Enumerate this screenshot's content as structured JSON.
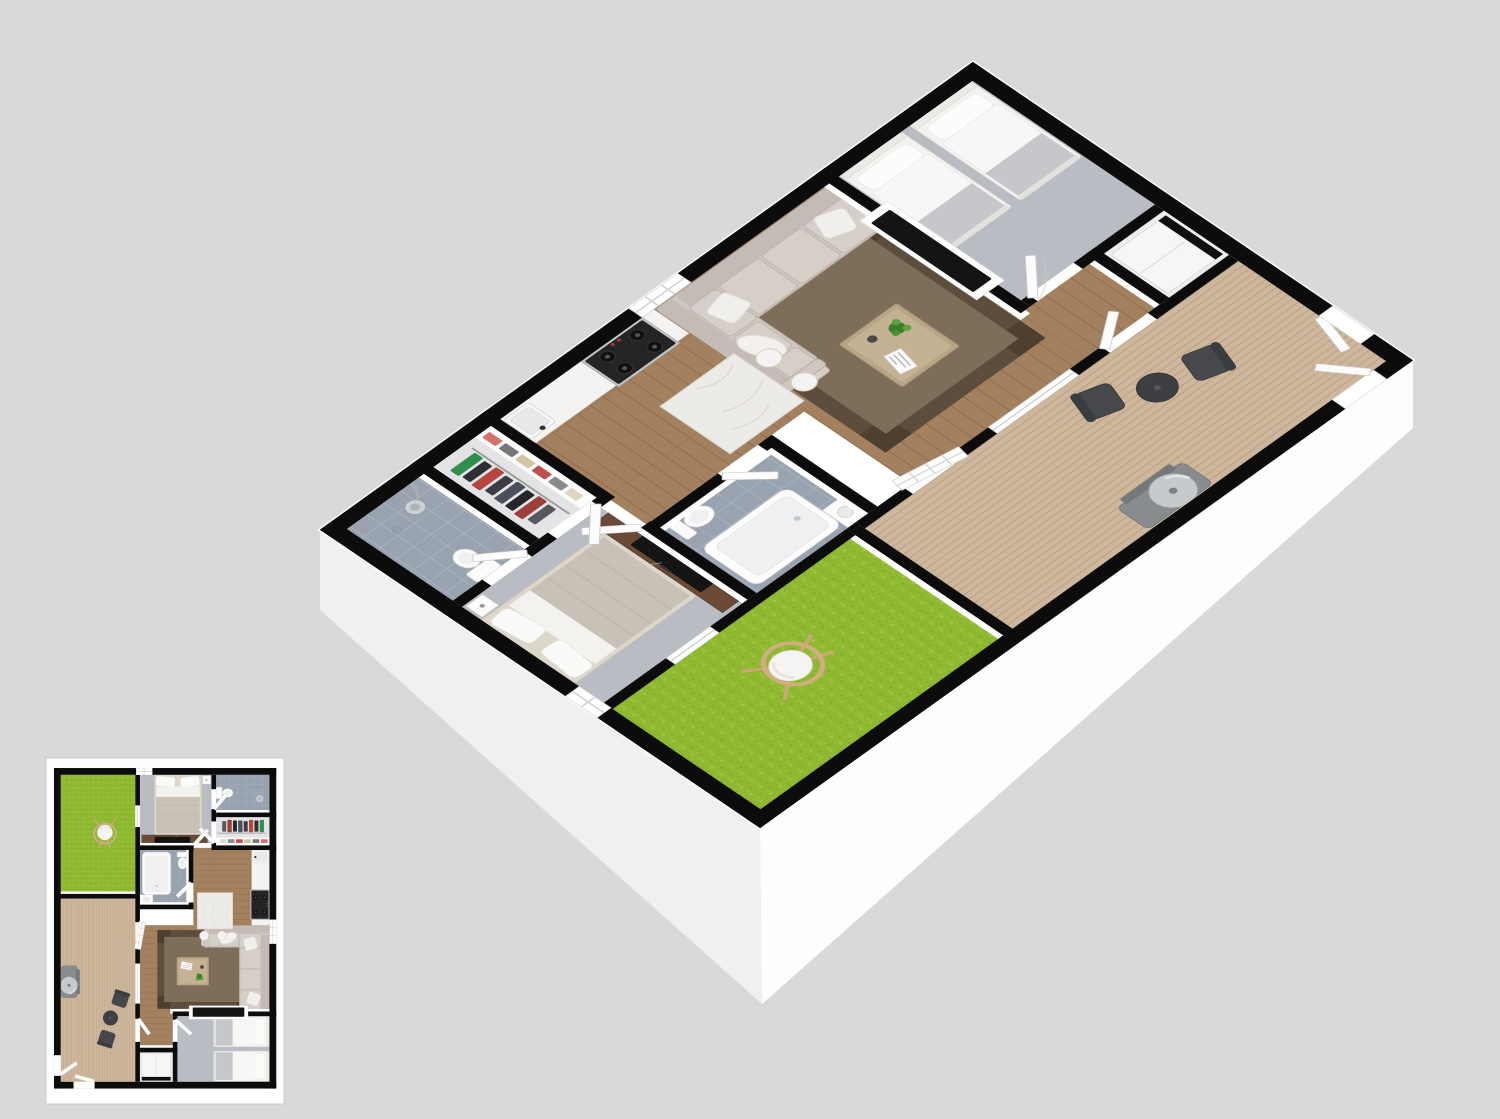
{
  "scene": {
    "kind": "3d-floor-plan-render",
    "main_view": "isometric-3d-floor-plan",
    "thumbnail_view": "2d-top-down-floor-plan",
    "rooms": [
      "living-room",
      "twin-bedroom",
      "kitchen",
      "hallway",
      "bathroom",
      "walk-in-closet",
      "shower-bathroom",
      "master-bedroom",
      "deck",
      "grass-yard",
      "utility-closet"
    ],
    "furniture": [
      "sectional-sofa",
      "coffee-table",
      "wall-tv",
      "twin-bed",
      "twin-bed",
      "kitchen-stove",
      "kitchen-island",
      "bar-stool",
      "bar-stool",
      "kitchen-sink",
      "bathtub",
      "toilet",
      "vanity-sink",
      "clothes-shelf",
      "hanging-clothes",
      "shower-head",
      "master-bed",
      "tv-console",
      "nightstand",
      "deck-chair",
      "deck-chair",
      "deck-table",
      "bbq-grill",
      "baby-gate",
      "hanging-egg-chair",
      "water-heater"
    ]
  },
  "palette": {
    "bg": "#d9d9da",
    "wall": "#0c0c0c",
    "wood": "#a3815f",
    "wood_line": "#876549",
    "deck": "#cdb69b",
    "deck_line": "#b3987a",
    "grass": "#8fb931",
    "grass_dark": "#7da227",
    "carpet": "#b9bcc3",
    "tile": "#99a3b0",
    "tile_line": "#a9b3bf",
    "rug_border": "#5d4d3c",
    "rug_center": "#7e6e59",
    "sofa": "#cfc8c1",
    "sofa_line": "#b7aea5",
    "marble": "#edebe7",
    "counter": "#f4f3f1",
    "tv": "#141414",
    "console": "#6b4a36",
    "chair_dark": "#46484b",
    "table_dark": "#3d3f42",
    "grill": "#c6cacd",
    "frame_tan": "#c9a878",
    "skirt_left": "#f0f0f2",
    "skirt_right": "#fdfdfd",
    "white": "#ffffff"
  }
}
